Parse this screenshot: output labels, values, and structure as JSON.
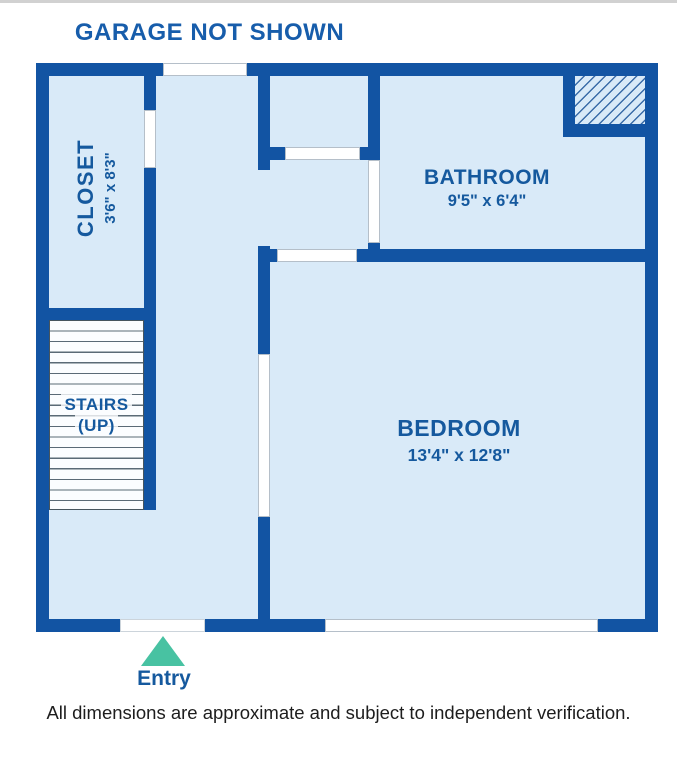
{
  "page": {
    "title": "GARAGE NOT SHOWN",
    "disclaimer": "All dimensions are approximate and subject to independent verification."
  },
  "entry": {
    "label": "Entry"
  },
  "rooms": {
    "closet": {
      "name": "CLOSET",
      "dimensions": "3'6\" x 8'3\""
    },
    "bathroom": {
      "name": "BATHROOM",
      "dimensions": "9'5\" x 6'4\""
    },
    "bedroom": {
      "name": "BEDROOM",
      "dimensions": "13'4\" x 12'8\""
    },
    "stairs": {
      "name": "STAIRS",
      "direction": "(UP)"
    }
  },
  "icons": {
    "entry_arrow": "triangle-up-icon",
    "stairs_pattern": "stair-treads",
    "hatch_pattern": "diagonal-hatch"
  },
  "colors": {
    "wall": "#1254a3",
    "floor": "#d9eaf8",
    "label": "#15599e",
    "title": "#175dab",
    "entry_arrow": "#48c2a2",
    "disclaimer_text": "#1d1d1d",
    "stair_line": "#5a6a76",
    "opening_border": "#b5bfc9"
  }
}
